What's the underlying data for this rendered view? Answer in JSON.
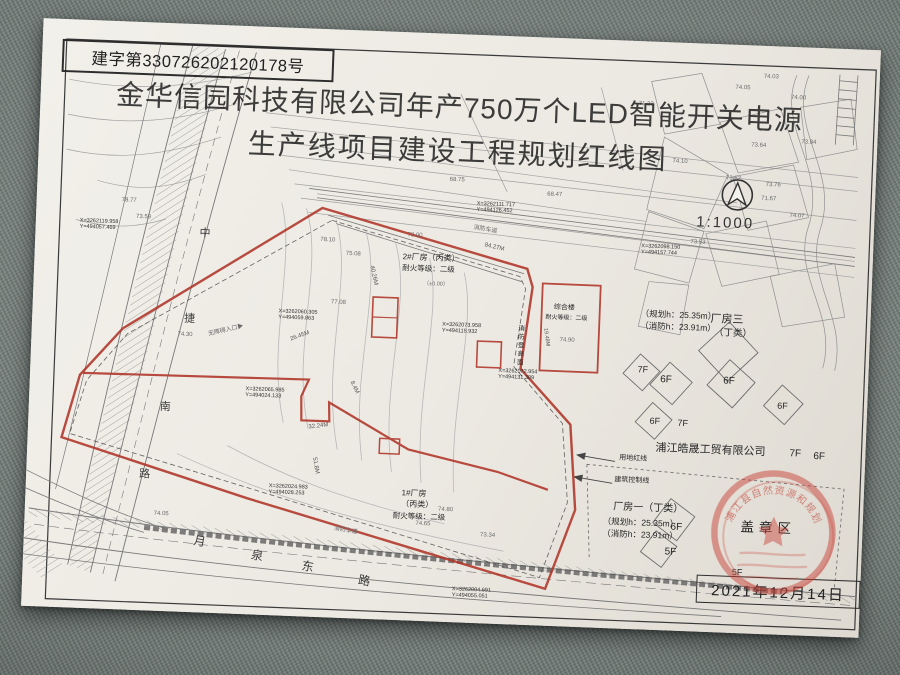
{
  "colors": {
    "redline": "#b03428",
    "seal": "#c8443a",
    "paper": "#ece9e2",
    "fabric": "#78827e",
    "ink": "#2d2d2d"
  },
  "document": {
    "serial": "建字第330726202120178号",
    "title_line1": "金华信园科技有限公司年产750万个LED智能开关电源",
    "title_line2": "生产线项目建设工程规划红线图",
    "scale": "1:1000",
    "date": "2021年12月14日",
    "stamp_area_label": "盖章区",
    "seal_arc_text": "浦江县自然资源和规划局"
  },
  "map": {
    "labels": [
      {
        "t": "X=3262119.958\nY=494057.469",
        "x": 44,
        "y": 198,
        "s": 5.5,
        "c": "coord"
      },
      {
        "t": "X=3262111.717\nY=494126.452",
        "x": 440,
        "y": 166,
        "s": 5.5,
        "c": "coord"
      },
      {
        "t": "X=3262098.150\nY=494157.744",
        "x": 606,
        "y": 202,
        "s": 5.5,
        "c": "coord"
      },
      {
        "t": "X=3262060.305\nY=494059.863",
        "x": 246,
        "y": 281,
        "s": 5.5,
        "c": "coord"
      },
      {
        "t": "X=3262073.958\nY=494115.932",
        "x": 410,
        "y": 288,
        "s": 5.5,
        "c": "coord"
      },
      {
        "t": "X=3262072.954\nY=494131.309",
        "x": 468,
        "y": 332,
        "s": 5.5,
        "c": "coord"
      },
      {
        "t": "X=3262065.985\nY=494024.133",
        "x": 216,
        "y": 360,
        "s": 5.5,
        "c": "coord"
      },
      {
        "t": "X=3262024.983\nY=494028.253",
        "x": 243,
        "y": 456,
        "s": 5.5,
        "c": "coord"
      },
      {
        "t": "X=3262004.691\nY=494055.051",
        "x": 430,
        "y": 552,
        "s": 5.5,
        "c": "coord"
      },
      {
        "t": "2#厂房（丙类）",
        "x": 368,
        "y": 220,
        "s": 8,
        "c": "name"
      },
      {
        "t": "耐火等级：二级",
        "x": 368,
        "y": 232,
        "s": 7.5,
        "c": "name"
      },
      {
        "t": "（±0.00）",
        "x": 390,
        "y": 248,
        "s": 5.5,
        "c": "tiny"
      },
      {
        "t": "综合楼",
        "x": 521,
        "y": 266,
        "s": 7,
        "c": "name"
      },
      {
        "t": "耐火等级：二级",
        "x": 513,
        "y": 277,
        "s": 6,
        "c": "name"
      },
      {
        "t": "1#厂房",
        "x": 376,
        "y": 456,
        "s": 8,
        "c": "name"
      },
      {
        "t": "（丙类）",
        "x": 376,
        "y": 467,
        "s": 8,
        "c": "name"
      },
      {
        "t": "耐火等级：二级",
        "x": 368,
        "y": 480,
        "s": 7.5,
        "c": "name"
      },
      {
        "t": "厂房三",
        "x": 678,
        "y": 269,
        "s": 11,
        "c": "name"
      },
      {
        "t": "（丁类）",
        "x": 682,
        "y": 283,
        "s": 9.5,
        "c": "name"
      },
      {
        "t": "（规划h：25.35m）",
        "x": 608,
        "y": 267,
        "s": 8.5,
        "c": "name"
      },
      {
        "t": "（消防h：23.91m）",
        "x": 608,
        "y": 279,
        "s": 8.5,
        "c": "name"
      },
      {
        "t": "厂房一（丁类）",
        "x": 588,
        "y": 461,
        "s": 10,
        "c": "name"
      },
      {
        "t": "（规划h：25.35m）",
        "x": 578,
        "y": 476,
        "s": 8.5,
        "c": "name"
      },
      {
        "t": "（消防h：23.91m）",
        "x": 578,
        "y": 488,
        "s": 8.5,
        "c": "name"
      },
      {
        "t": "浦江皓晟工贸有限公司",
        "x": 628,
        "y": 400,
        "s": 11,
        "c": "name"
      },
      {
        "t": "7F",
        "x": 762,
        "y": 401,
        "s": 10,
        "c": "name"
      },
      {
        "t": "6F",
        "x": 786,
        "y": 403,
        "s": 10,
        "c": "name"
      },
      {
        "t": "7F",
        "x": 607,
        "y": 323,
        "s": 9,
        "c": "name"
      },
      {
        "t": "6F",
        "x": 630,
        "y": 332,
        "s": 10,
        "c": "name"
      },
      {
        "t": "6F",
        "x": 693,
        "y": 331,
        "s": 10,
        "c": "name"
      },
      {
        "t": "6F",
        "x": 748,
        "y": 354,
        "s": 9,
        "c": "name"
      },
      {
        "t": "6F",
        "x": 621,
        "y": 374,
        "s": 9,
        "c": "name"
      },
      {
        "t": "7F",
        "x": 649,
        "y": 375,
        "s": 9,
        "c": "name"
      },
      {
        "t": "6F",
        "x": 646,
        "y": 479,
        "s": 10,
        "c": "name"
      },
      {
        "t": "5F",
        "x": 641,
        "y": 504,
        "s": 10,
        "c": "name"
      },
      {
        "t": "5F",
        "x": 709,
        "y": 522,
        "s": 9,
        "c": "name"
      },
      {
        "t": "消防登高面",
        "x": 484,
        "y": 288,
        "s": 6.5,
        "c": "vert name"
      },
      {
        "t": "用地红线",
        "x": 592,
        "y": 414,
        "s": 7,
        "c": "name"
      },
      {
        "t": "建筑控制线",
        "x": 588,
        "y": 436,
        "s": 7,
        "c": "name"
      },
      {
        "t": "无障碍入口▶",
        "x": 176,
        "y": 307,
        "s": 6,
        "c": "tiny",
        "r": -15
      },
      {
        "t": "消防车道",
        "x": 438,
        "y": 190,
        "s": 6,
        "c": "tiny",
        "r": 8
      },
      {
        "t": "消防车道",
        "x": 310,
        "y": 496,
        "s": 6,
        "c": "tiny",
        "r": 8
      },
      {
        "t": "中",
        "x": 164,
        "y": 203,
        "s": 11,
        "c": "road"
      },
      {
        "t": "捷",
        "x": 152,
        "y": 289,
        "s": 11,
        "c": "road"
      },
      {
        "t": "南",
        "x": 131,
        "y": 378,
        "s": 11,
        "c": "road"
      },
      {
        "t": "路",
        "x": 113,
        "y": 446,
        "s": 11,
        "c": "road"
      },
      {
        "t": "月",
        "x": 171,
        "y": 509,
        "s": 12,
        "c": "road",
        "r": 8
      },
      {
        "t": "泉",
        "x": 229,
        "y": 521,
        "s": 12,
        "c": "road",
        "r": 8
      },
      {
        "t": "东",
        "x": 280,
        "y": 530,
        "s": 12,
        "c": "road",
        "r": 8
      },
      {
        "t": "路",
        "x": 337,
        "y": 542,
        "s": 12,
        "c": "road",
        "r": 8
      },
      {
        "t": "84.27M",
        "x": 450,
        "y": 207,
        "s": 6,
        "c": "dim",
        "r": 11
      },
      {
        "t": "32.24M",
        "x": 280,
        "y": 396,
        "s": 6,
        "c": "dim",
        "r": -9
      },
      {
        "t": "26.45M",
        "x": 258,
        "y": 309,
        "s": 6,
        "c": "dim",
        "r": -22
      },
      {
        "t": "40.26M",
        "x": 340,
        "y": 234,
        "s": 6,
        "c": "dim",
        "r": 76
      },
      {
        "t": "51.8M",
        "x": 290,
        "y": 428,
        "s": 6,
        "c": "dim",
        "r": 78
      },
      {
        "t": "8.4M",
        "x": 324,
        "y": 350,
        "s": 6,
        "c": "dim",
        "r": 62
      },
      {
        "t": "19.48M",
        "x": 516,
        "y": 290,
        "s": 5.5,
        "c": "dim",
        "r": 80
      },
      {
        "t": "74.90",
        "x": 528,
        "y": 299,
        "s": 6,
        "c": "tiny"
      },
      {
        "t": "74.03",
        "x": 722,
        "y": 28,
        "s": 6,
        "c": "tiny"
      },
      {
        "t": "74.00",
        "x": 750,
        "y": 48,
        "s": 6,
        "c": "tiny"
      },
      {
        "t": "74.05",
        "x": 694,
        "y": 40,
        "s": 6,
        "c": "tiny"
      },
      {
        "t": "73.84",
        "x": 762,
        "y": 92,
        "s": 6,
        "c": "tiny"
      },
      {
        "t": "73.64",
        "x": 712,
        "y": 97,
        "s": 6,
        "c": "tiny"
      },
      {
        "t": "73.62",
        "x": 688,
        "y": 131,
        "s": 6,
        "c": "tiny"
      },
      {
        "t": "73.76",
        "x": 728,
        "y": 136,
        "s": 6,
        "c": "tiny"
      },
      {
        "t": "74.07",
        "x": 753,
        "y": 166,
        "s": 6,
        "c": "tiny"
      },
      {
        "t": "71.67",
        "x": 724,
        "y": 150,
        "s": 6,
        "c": "tiny"
      },
      {
        "t": "74.10",
        "x": 634,
        "y": 116,
        "s": 6,
        "c": "tiny"
      },
      {
        "t": "71.23",
        "x": 598,
        "y": 60,
        "s": 6,
        "c": "tiny"
      },
      {
        "t": "73.53",
        "x": 655,
        "y": 196,
        "s": 6,
        "c": "tiny"
      },
      {
        "t": "68.47",
        "x": 510,
        "y": 154,
        "s": 6,
        "c": "tiny"
      },
      {
        "t": "68.75",
        "x": 412,
        "y": 143,
        "s": 6,
        "c": "tiny"
      },
      {
        "t": "78.10",
        "x": 285,
        "y": 208,
        "s": 6,
        "c": "tiny"
      },
      {
        "t": "75.08",
        "x": 311,
        "y": 221,
        "s": 6,
        "c": "tiny"
      },
      {
        "t": "78.00",
        "x": 372,
        "y": 200,
        "s": 6,
        "c": "tiny"
      },
      {
        "t": "77.08",
        "x": 298,
        "y": 270,
        "s": 6,
        "c": "tiny"
      },
      {
        "t": "74.80",
        "x": 413,
        "y": 473,
        "s": 6,
        "c": "tiny"
      },
      {
        "t": "73.34",
        "x": 456,
        "y": 497,
        "s": 6,
        "c": "tiny"
      },
      {
        "t": "74.65",
        "x": 391,
        "y": 488,
        "s": 6,
        "c": "tiny"
      },
      {
        "t": "74.30",
        "x": 146,
        "y": 308,
        "s": 6,
        "c": "tiny"
      },
      {
        "t": "73.59",
        "x": 100,
        "y": 192,
        "s": 6,
        "c": "tiny"
      },
      {
        "t": "78.77",
        "x": 85,
        "y": 176,
        "s": 6,
        "c": "tiny"
      },
      {
        "t": "74.05",
        "x": 129,
        "y": 488,
        "s": 6,
        "c": "tiny"
      }
    ]
  }
}
